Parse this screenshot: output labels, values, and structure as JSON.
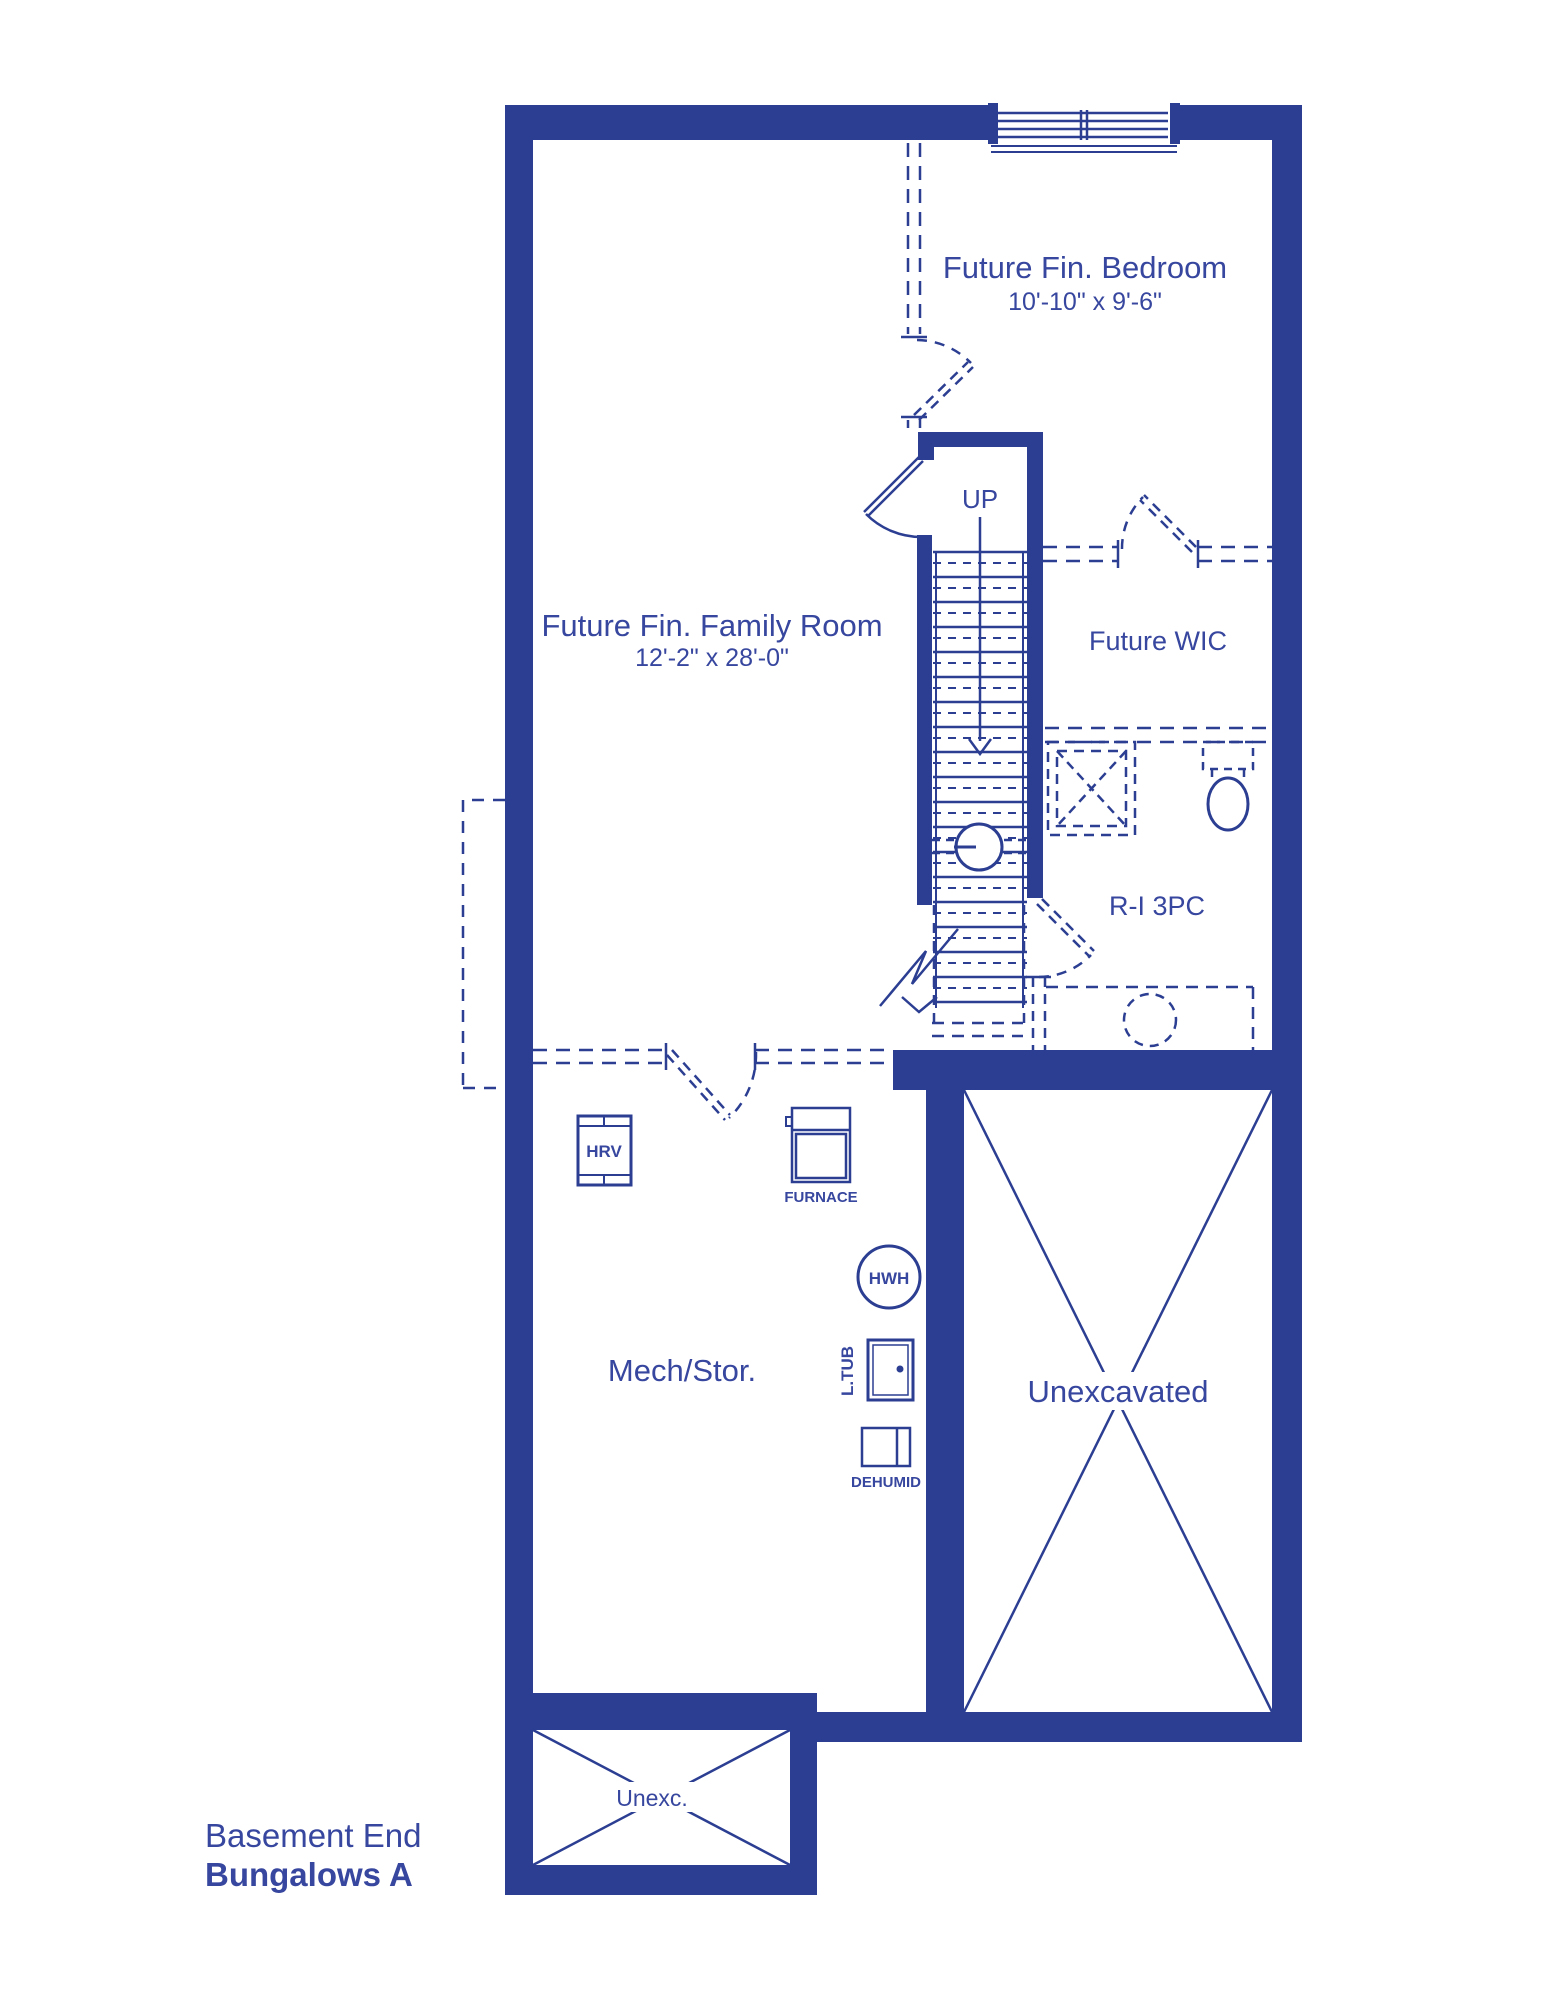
{
  "title": {
    "line1": "Basement End",
    "line2": "Bungalows A"
  },
  "rooms": {
    "bedroom": {
      "name": "Future Fin. Bedroom",
      "dims": "10'-10\" x 9'-6\""
    },
    "family_room": {
      "name": "Future Fin. Family Room",
      "dims": "12'-2\" x 28'-0\""
    },
    "wic": {
      "name": "Future WIC"
    },
    "bathroom": {
      "name": "R-I 3PC"
    },
    "mech_storage": {
      "name": "Mech/Stor."
    },
    "unexcavated": {
      "name": "Unexcavated"
    },
    "unexcavated_small": {
      "name": "Unexc."
    }
  },
  "equipment": {
    "hrv": "HRV",
    "furnace": "FURNACE",
    "hot_water_heater": "HWH",
    "laundry_tub": "L.TUB",
    "dehumidifier": "DEHUMID"
  },
  "stairs": {
    "direction_label": "UP"
  },
  "colors": {
    "ink": "#2b3e92",
    "text": "#37469e",
    "background": "#ffffff"
  }
}
